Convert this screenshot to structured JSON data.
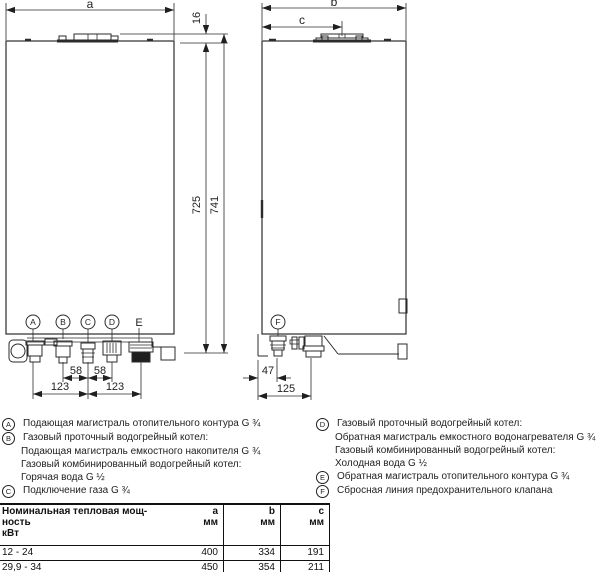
{
  "drawing": {
    "front_view": {
      "dim_width": "a",
      "dim_flue_offset": "16",
      "dim_height_body": "725",
      "dim_height_total": "741",
      "dim_bc": "58",
      "dim_cd": "58",
      "dim_ac": "123",
      "dim_ce": "123",
      "markers": {
        "A": "A",
        "B": "B",
        "C": "C",
        "D": "D",
        "E": "E"
      }
    },
    "side_view": {
      "dim_depth": "b",
      "dim_flue_center": "c",
      "dim_f_offset": "47",
      "dim_pipe_offset": "125",
      "markers": {
        "F": "F"
      }
    }
  },
  "legend_left": [
    {
      "key": "A",
      "text": "Подающая магистраль отопительного контура G ¾"
    },
    {
      "key": "B",
      "text": "Газовый проточный водогрейный котел:"
    },
    {
      "key": "",
      "text": "Подающая магистраль емкостного накопителя G ¾"
    },
    {
      "key": "",
      "text": "Газовый комбинированный водогрейный котел:"
    },
    {
      "key": "",
      "text": "Горячая вода G ½"
    },
    {
      "key": "C",
      "text": "Подключение газа G ¾"
    }
  ],
  "legend_right": [
    {
      "key": "D",
      "text": "Газовый проточный водогрейный котел:"
    },
    {
      "key": "",
      "text": "Обратная магистраль емкостного водонагревателя G ¾"
    },
    {
      "key": "",
      "text": "Газовый комбинированный водогрейный котел:"
    },
    {
      "key": "",
      "text": "Холодная вода G ½"
    },
    {
      "key": "E",
      "text": "Обратная магистраль отопительного контура G ¾"
    },
    {
      "key": "F",
      "text": "Сбросная линия предохранительного клапана"
    }
  ],
  "table": {
    "header": {
      "title_line1": "Номинальная тепловая мощ-",
      "title_line2": "ность",
      "title_line3": "кВт",
      "col_a": "a",
      "col_b": "b",
      "col_c": "c",
      "unit": "мм"
    },
    "rows": [
      {
        "power": "12 - 24",
        "a": "400",
        "b": "334",
        "c": "191"
      },
      {
        "power": "29,9 - 34",
        "a": "450",
        "b": "354",
        "c": "211"
      }
    ]
  }
}
